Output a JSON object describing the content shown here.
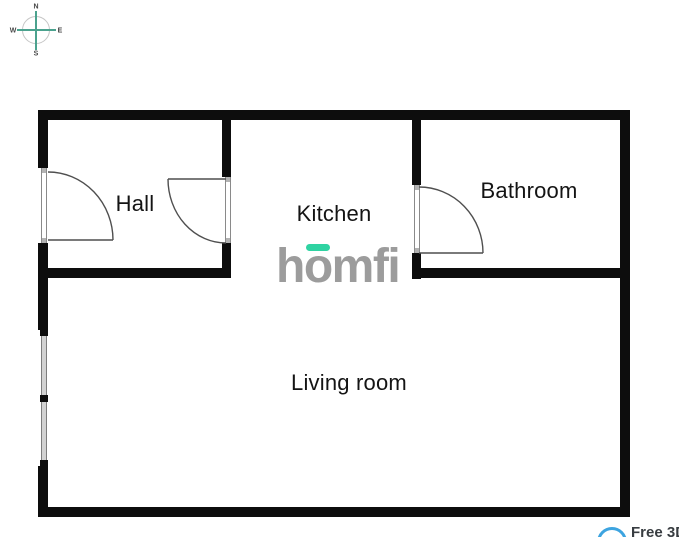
{
  "compass": {
    "north": "N",
    "east": "E",
    "south": "S",
    "west": "W",
    "accent_color": "#4ba28e"
  },
  "rooms": {
    "hall": {
      "label": "Hall"
    },
    "kitchen": {
      "label": "Kitchen"
    },
    "bathroom": {
      "label": "Bathroom"
    },
    "living_room": {
      "label": "Living room"
    }
  },
  "logo": {
    "h": "h",
    "o": "o",
    "mfi": "mfi",
    "text_color": "#9c9c9c",
    "accent_color": "#2fd3a2"
  },
  "badge": {
    "label": "Free 3D",
    "ring_color": "#3da4e0"
  },
  "colors": {
    "wall": "#0d0d0d",
    "window_fill": "#d2d2d2",
    "door_line": "#4f4f4f"
  }
}
